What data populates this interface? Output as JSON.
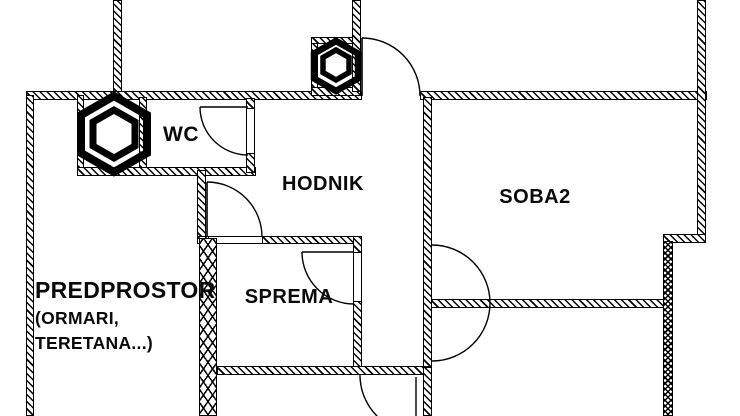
{
  "plan": {
    "type": "apartment-floor-plan",
    "background_color": "#ffffff",
    "line_color": "#000000",
    "rooms": {
      "wc": {
        "label": "WC"
      },
      "hodnik": {
        "label": "HODNIK"
      },
      "soba2": {
        "label": "SOBA2"
      },
      "sprema": {
        "label": "SPREMA"
      },
      "predprostor": {
        "label": "PREDPROSTOR",
        "note_line1": "(ORMARI,",
        "note_line2": "TERETANA...)"
      }
    },
    "icons": {
      "shaft_large": "hexagon-shaft-symbol-large",
      "shaft_small": "hexagon-shaft-symbol-small"
    },
    "doors_count": 6
  }
}
